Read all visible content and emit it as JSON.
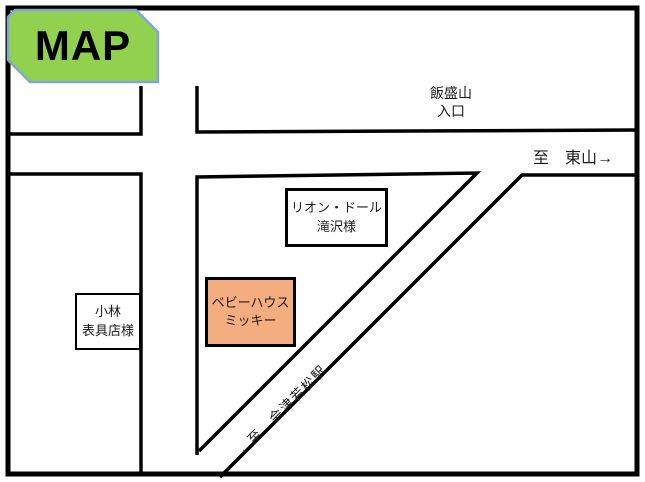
{
  "badge": {
    "title": "MAP"
  },
  "colors": {
    "badge_bg": "#92D050",
    "badge_border": "#7FA8D0",
    "baby_house_bg": "#F4AD7E",
    "line": "#000000"
  },
  "labels": {
    "iimoriyama_line1": "飯盛山",
    "iimoriyama_line2": "入口",
    "to_higashiyama": "至　東山→",
    "to_station": "←至　会津若松駅"
  },
  "buildings": {
    "lion_dor_line1": "リオン・ドール",
    "lion_dor_line2": "滝沢様",
    "baby_house_line1": "ベビーハウス",
    "baby_house_line2": "ミッキー",
    "kobayashi_line1": "小林",
    "kobayashi_line2": "表具店様"
  }
}
